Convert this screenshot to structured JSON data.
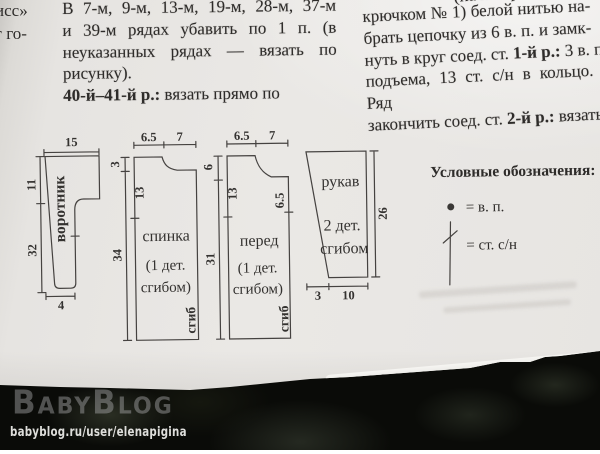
{
  "fragments": {
    "f1": "исс»",
    "f2": "г го-"
  },
  "left_column": {
    "l1": "В 7-м, 9-м, 13-м, 19-м, 28-м, 37-м",
    "l2": "и 39-м рядах убавить по 1 п. (в",
    "l3": "неуказанных рядах — вязать по",
    "l4": "рисунку).",
    "l5_bold": "40-й–41-й р.:",
    "l5_rest": " вязать прямо по"
  },
  "right_column": {
    "l0": "(начать работу",
    "l1": "крючком № 1) белой нитью на-",
    "l2": "брать цепочку из 6 в. п. и замк-",
    "l3_pre": "нуть в круг соед. ст. ",
    "l3_bold": "1-й р.:",
    "l3_post": " 3 в. п.",
    "l4": "подъема, 13 ст. с/н в кольцо. Ряд",
    "l5_pre": "закончить соед. ст. ",
    "l5_bold": "2-й р.:",
    "l5_post": " вязать"
  },
  "diagrams": {
    "collar": {
      "name": "воротник",
      "w_top": "15",
      "h_upper": "11",
      "h_lower": "32",
      "w_bottom": "4"
    },
    "back": {
      "name": "спинка",
      "line2": "(1 дет.",
      "line3": "сгибом)",
      "fold": "сгиб",
      "w_left": "6.5",
      "w_right": "7",
      "d_neck": "3",
      "h_side": "34",
      "inner_h": "13"
    },
    "front": {
      "name": "перед",
      "line2": "(1 дет.",
      "line3": "сгибом)",
      "fold": "сгиб",
      "w_left": "6.5",
      "w_right": "7",
      "d_neck": "6",
      "h_side": "31",
      "inner_h": "13",
      "inner_r": "6.5"
    },
    "sleeve": {
      "name": "рукав",
      "line2": "2 дет.",
      "line3": "сгибом",
      "h_right": "26",
      "w_b_left": "3",
      "w_b_right": "10"
    }
  },
  "legend": {
    "title": "Условные обозначения:",
    "item1": "= в. п.",
    "item2": "= ст. с/н"
  },
  "watermark": {
    "logo": "BabyBlog",
    "url": "babyblog.ru/user/elenapigina"
  },
  "colors": {
    "paper": "#e8e6e3",
    "ink": "#2e2c2a",
    "leather": "#0a0b08",
    "stroke": "#454240"
  }
}
